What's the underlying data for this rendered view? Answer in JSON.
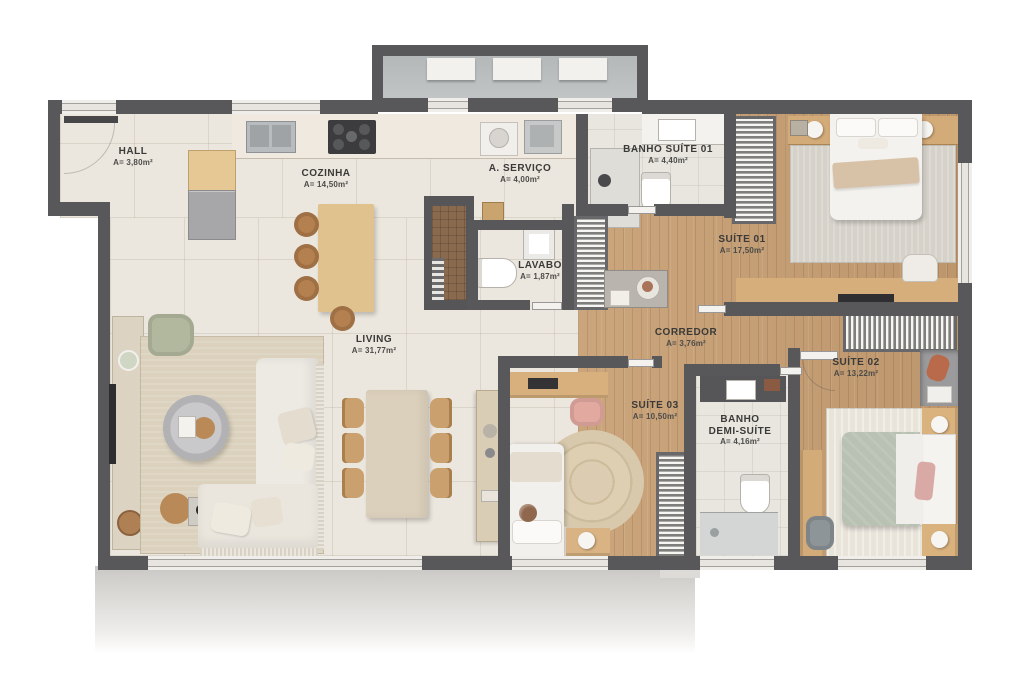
{
  "rooms": {
    "hall": {
      "name": "HALL",
      "area": "A= 3,80m²"
    },
    "cozinha": {
      "name": "COZINHA",
      "area": "A= 14,50m²"
    },
    "servico": {
      "name": "A. SERVIÇO",
      "area": "A= 4,00m²"
    },
    "banho_suite_01": {
      "name": "BANHO SUÍTE 01",
      "area": "A= 4,40m²"
    },
    "suite_01": {
      "name": "SUÍTE 01",
      "area": "A= 17,50m²"
    },
    "lavabo": {
      "name": "LAVABO",
      "area": "A= 1,87m²"
    },
    "corredor": {
      "name": "CORREDOR",
      "area": "A= 3,76m²"
    },
    "living": {
      "name": "LIVING",
      "area": "A= 31,77m²"
    },
    "suite_03": {
      "name": "SUÍTE 03",
      "area": "A= 10,50m²"
    },
    "banho_demi_suite": {
      "name_line1": "BANHO",
      "name_line2": "DEMI-SUÍTE",
      "area": "A= 4,16m²"
    },
    "suite_02": {
      "name": "SUÍTE 02",
      "area": "A= 13,22m²"
    }
  },
  "palette": {
    "wall": "#58585a",
    "wood_floor": "#c79e72",
    "tile_floor": "#ece7de",
    "bath_floor": "#e9e6e0",
    "balcony_floor": "#b8bcbc",
    "rug": "#dbd1bd",
    "accent_wood": "#dcb984",
    "bed_sage": "#b8c1b2",
    "label_text": "#3a3a38"
  }
}
